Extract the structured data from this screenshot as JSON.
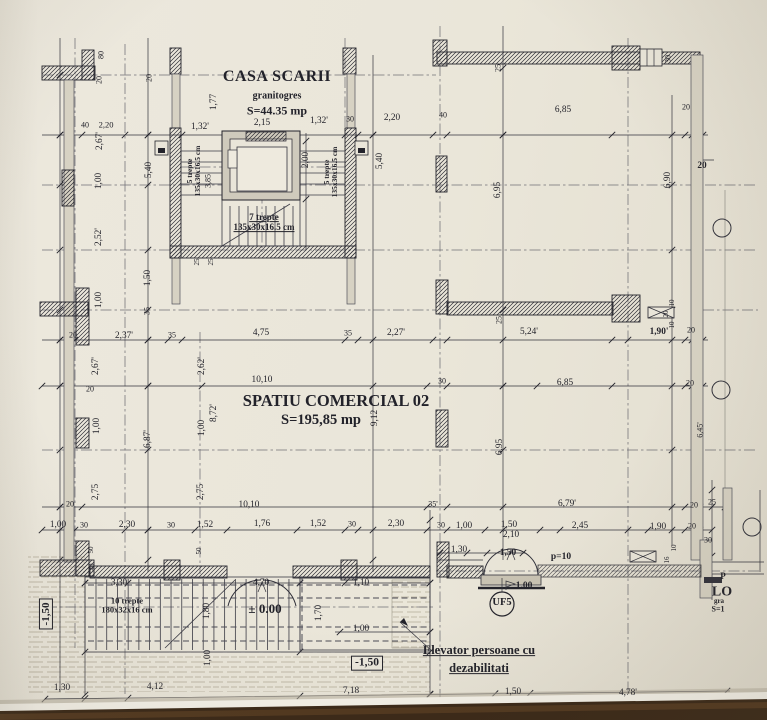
{
  "colors": {
    "paper": "#e9e5d9",
    "ink": "#22222a",
    "wood": "#47301a"
  },
  "rooms": {
    "stairwell": {
      "title": "CASA SCARII",
      "finish": "granitogres",
      "area": "S=44.35 mp"
    },
    "commercial": {
      "title": "SPATIU COMERCIAL 02",
      "area": "S=195,85 mp"
    },
    "edge_cut": {
      "p": "P",
      "lo": "LO",
      "gra": "gra",
      "s1": "S=1"
    }
  },
  "levels": {
    "platform": "± 0.00",
    "left_exterior": "-1,50",
    "right_exterior": "-1,50",
    "parapet": "p=10",
    "threshold": "1.00"
  },
  "callouts": {
    "elevator_line1": "Elevator persoane cu",
    "elevator_line2": "dezabilitati",
    "uf": "UF5"
  },
  "stairs": {
    "left_flight_l1": "5 trepte",
    "left_flight_l2": "135x30x16.5 cm",
    "right_flight_l1": "5 trepte",
    "right_flight_l2": "135x30x16.5 cm",
    "bottom_flight_l1": "7 trepte",
    "bottom_flight_l2": "135x30x16.5 cm",
    "entrance_l1": "10 trepte",
    "entrance_l2": "180x32x16 cm"
  },
  "dimensions": [
    {
      "t": "40",
      "x": 85,
      "y": 126,
      "s": 8
    },
    {
      "t": "2,20",
      "x": 106,
      "y": 125,
      "s": 8.5
    },
    {
      "t": "1,32'",
      "x": 200,
      "y": 127
    },
    {
      "t": "2,15",
      "x": 262,
      "y": 123
    },
    {
      "t": "1,32'",
      "x": 319,
      "y": 121
    },
    {
      "t": "30",
      "x": 350,
      "y": 120,
      "s": 8
    },
    {
      "t": "2,20",
      "x": 392,
      "y": 118
    },
    {
      "t": "40",
      "x": 443,
      "y": 116,
      "s": 8
    },
    {
      "t": "6,85",
      "x": 563,
      "y": 110
    },
    {
      "t": "20",
      "x": 686,
      "y": 108,
      "s": 8
    },
    {
      "t": "20",
      "x": 702,
      "y": 166,
      "b": 1
    },
    {
      "t": "80",
      "x": 102,
      "y": 55,
      "r": 1,
      "s": 8
    },
    {
      "t": "20",
      "x": 100,
      "y": 80,
      "r": 1,
      "s": 8
    },
    {
      "t": "20",
      "x": 150,
      "y": 78,
      "r": 1,
      "s": 8
    },
    {
      "t": "1,77",
      "x": 214,
      "y": 102,
      "r": 1
    },
    {
      "t": "2,67'",
      "x": 100,
      "y": 141,
      "r": 1
    },
    {
      "t": "30",
      "x": 669,
      "y": 59,
      "r": 1,
      "s": 8
    },
    {
      "t": "25",
      "x": 499,
      "y": 68,
      "r": 1,
      "s": 8
    },
    {
      "t": "5,40",
      "x": 149,
      "y": 170,
      "r": 1
    },
    {
      "t": "5,40",
      "x": 380,
      "y": 161,
      "r": 1
    },
    {
      "t": "2,00",
      "x": 306,
      "y": 160,
      "r": 1
    },
    {
      "t": "3,85",
      "x": 209,
      "y": 181,
      "r": 1,
      "s": 8
    },
    {
      "t": "25",
      "x": 198,
      "y": 262,
      "r": 1,
      "s": 7
    },
    {
      "t": "25",
      "x": 212,
      "y": 262,
      "r": 1,
      "s": 7
    },
    {
      "t": "2,52'",
      "x": 99,
      "y": 237,
      "r": 1
    },
    {
      "t": "1,00",
      "x": 99,
      "y": 181,
      "r": 1
    },
    {
      "t": "1,50",
      "x": 148,
      "y": 278,
      "r": 1
    },
    {
      "t": "1,00",
      "x": 99,
      "y": 300,
      "r": 1
    },
    {
      "t": "35",
      "x": 148,
      "y": 311,
      "r": 1,
      "s": 8
    },
    {
      "t": "6,95",
      "x": 498,
      "y": 190,
      "r": 1
    },
    {
      "t": "6,90",
      "x": 668,
      "y": 180,
      "r": 1
    },
    {
      "t": "20",
      "x": 90,
      "y": 390,
      "s": 8
    },
    {
      "t": "20",
      "x": 73,
      "y": 336,
      "s": 8
    },
    {
      "t": "2,37'",
      "x": 124,
      "y": 336
    },
    {
      "t": "35",
      "x": 172,
      "y": 336,
      "s": 8
    },
    {
      "t": "4,75",
      "x": 261,
      "y": 333
    },
    {
      "t": "35",
      "x": 348,
      "y": 334,
      "s": 8
    },
    {
      "t": "2,27'",
      "x": 396,
      "y": 333
    },
    {
      "t": "5,24'",
      "x": 529,
      "y": 332
    },
    {
      "t": "1,90'",
      "x": 659,
      "y": 332,
      "b": 1
    },
    {
      "t": "20",
      "x": 691,
      "y": 331,
      "s": 8
    },
    {
      "t": "25",
      "x": 500,
      "y": 320,
      "r": 1,
      "s": 8
    },
    {
      "t": "10",
      "x": 673,
      "y": 303,
      "r": 1,
      "s": 7
    },
    {
      "t": "20",
      "x": 667,
      "y": 314,
      "r": 1,
      "s": 7
    },
    {
      "t": "10",
      "x": 673,
      "y": 325,
      "r": 1,
      "s": 7
    },
    {
      "t": "10,10",
      "x": 262,
      "y": 380
    },
    {
      "t": "30",
      "x": 442,
      "y": 382,
      "s": 8
    },
    {
      "t": "6,85",
      "x": 565,
      "y": 383
    },
    {
      "t": "20",
      "x": 690,
      "y": 384,
      "s": 8
    },
    {
      "t": "2,67'",
      "x": 96,
      "y": 366,
      "r": 1
    },
    {
      "t": "2,62'",
      "x": 202,
      "y": 366,
      "r": 1
    },
    {
      "t": "8,72'",
      "x": 214,
      "y": 413,
      "r": 1
    },
    {
      "t": "9,12",
      "x": 375,
      "y": 418,
      "r": 1
    },
    {
      "t": "6,95",
      "x": 500,
      "y": 447,
      "r": 1
    },
    {
      "t": "6,45'",
      "x": 701,
      "y": 430,
      "r": 1,
      "s": 8
    },
    {
      "t": "1,00",
      "x": 97,
      "y": 426,
      "r": 1
    },
    {
      "t": "6,87'",
      "x": 148,
      "y": 439,
      "r": 1
    },
    {
      "t": "1,00",
      "x": 202,
      "y": 428,
      "r": 1
    },
    {
      "t": "2,75",
      "x": 96,
      "y": 492,
      "r": 1
    },
    {
      "t": "2,75",
      "x": 201,
      "y": 492,
      "r": 1
    },
    {
      "t": "20",
      "x": 70,
      "y": 505,
      "s": 8
    },
    {
      "t": "10,10",
      "x": 249,
      "y": 505
    },
    {
      "t": "35'",
      "x": 433,
      "y": 505,
      "s": 8
    },
    {
      "t": "6,79'",
      "x": 567,
      "y": 504
    },
    {
      "t": "20",
      "x": 694,
      "y": 506,
      "s": 8
    },
    {
      "t": "25",
      "x": 712,
      "y": 503,
      "s": 8
    },
    {
      "t": "1,00",
      "x": 58,
      "y": 525
    },
    {
      "t": "30",
      "x": 84,
      "y": 526,
      "s": 8
    },
    {
      "t": "2,30",
      "x": 127,
      "y": 525
    },
    {
      "t": "30",
      "x": 171,
      "y": 526,
      "s": 8
    },
    {
      "t": "1,52",
      "x": 205,
      "y": 525
    },
    {
      "t": "1,76",
      "x": 262,
      "y": 524
    },
    {
      "t": "1,52",
      "x": 318,
      "y": 524
    },
    {
      "t": "30",
      "x": 352,
      "y": 525,
      "s": 8
    },
    {
      "t": "2,30",
      "x": 396,
      "y": 524
    },
    {
      "t": "30",
      "x": 441,
      "y": 526,
      "s": 8
    },
    {
      "t": "1,00",
      "x": 464,
      "y": 526
    },
    {
      "t": "1,50",
      "x": 509,
      "y": 525
    },
    {
      "t": "2,10",
      "x": 511,
      "y": 535
    },
    {
      "t": "2,45",
      "x": 580,
      "y": 526
    },
    {
      "t": "1,90",
      "x": 658,
      "y": 527
    },
    {
      "t": "20",
      "x": 692,
      "y": 527,
      "s": 8
    },
    {
      "t": "30",
      "x": 708,
      "y": 541,
      "s": 8
    },
    {
      "t": "1,30",
      "x": 459,
      "y": 550
    },
    {
      "t": "1,50",
      "x": 508,
      "y": 553,
      "b": 1
    },
    {
      "t": "10",
      "x": 675,
      "y": 548,
      "r": 1,
      "s": 7
    },
    {
      "t": "16",
      "x": 668,
      "y": 560,
      "r": 1,
      "s": 7
    },
    {
      "t": "3,30",
      "x": 119,
      "y": 583
    },
    {
      "t": "4,70",
      "x": 261,
      "y": 583
    },
    {
      "t": "1,10",
      "x": 361,
      "y": 583
    },
    {
      "t": "1,80",
      "x": 207,
      "y": 611,
      "r": 1
    },
    {
      "t": "1,70",
      "x": 319,
      "y": 613,
      "r": 1
    },
    {
      "t": "1,00",
      "x": 361,
      "y": 629
    },
    {
      "t": "1,00",
      "x": 208,
      "y": 658,
      "r": 1
    },
    {
      "t": "50",
      "x": 92,
      "y": 550,
      "r": 1,
      "s": 7
    },
    {
      "t": "50",
      "x": 200,
      "y": 551,
      "r": 1,
      "s": 7
    },
    {
      "t": "40",
      "x": 93,
      "y": 567,
      "r": 1,
      "s": 7
    },
    {
      "t": "1,30",
      "x": 62,
      "y": 688
    },
    {
      "t": "4,12",
      "x": 155,
      "y": 687
    },
    {
      "t": "7,18",
      "x": 351,
      "y": 691
    },
    {
      "t": "1,50",
      "x": 513,
      "y": 692
    },
    {
      "t": "4,78'",
      "x": 628,
      "y": 693
    }
  ]
}
